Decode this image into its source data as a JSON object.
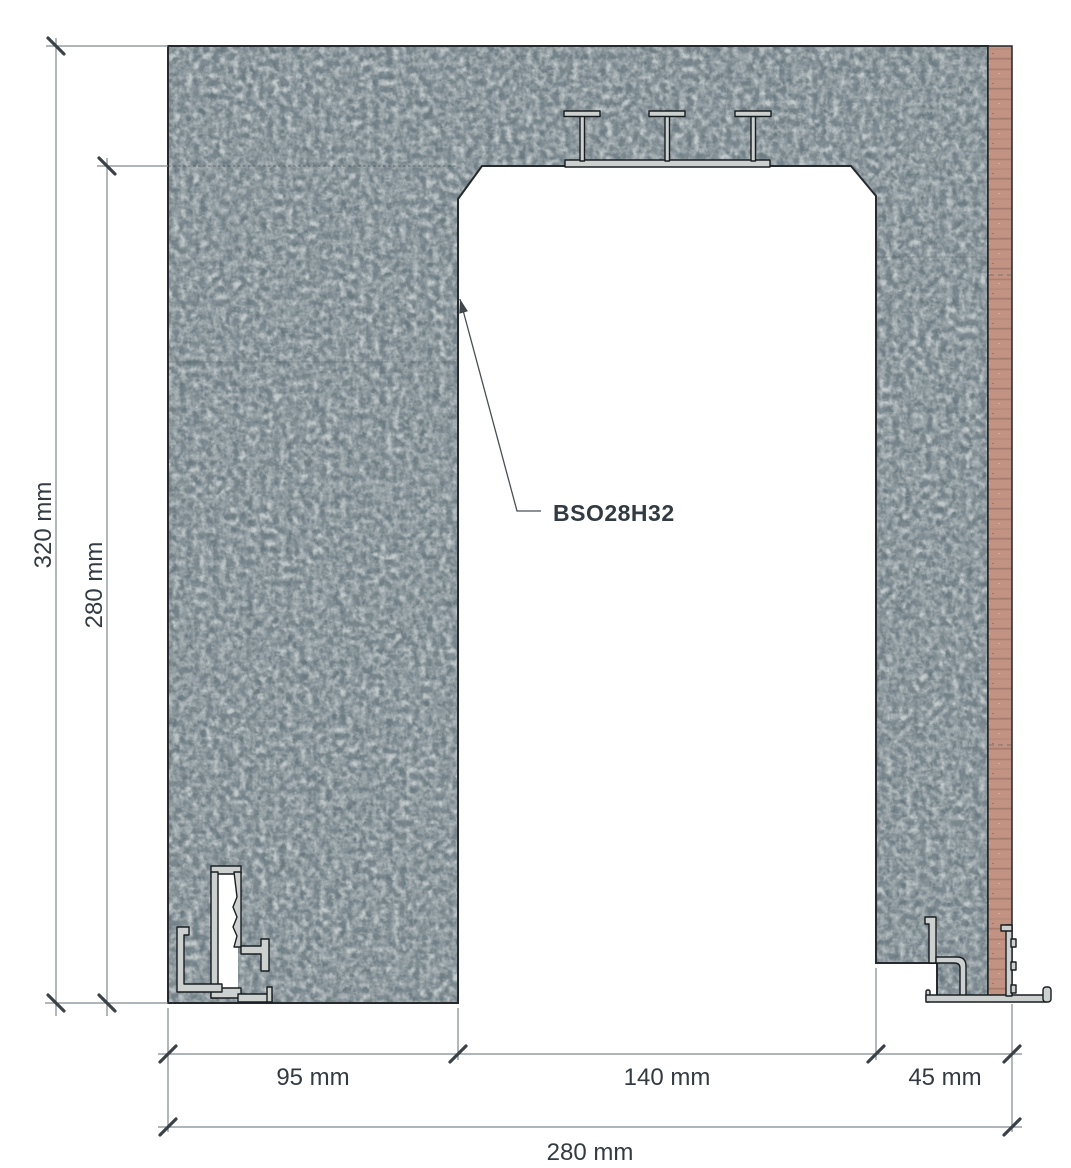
{
  "drawing": {
    "product_label": "BSO28H32",
    "dimensions": {
      "overall_height": "320 mm",
      "opening_height": "280 mm",
      "left_wall_width": "95 mm",
      "opening_width": "140 mm",
      "right_wall_width": "45 mm",
      "overall_width": "280 mm"
    },
    "legend": {
      "type": "technical cross-section of a pocket door frame (BSO28H32) in a masonry wall",
      "materials": [
        "masonry",
        "wood batten",
        "aluminium profiles"
      ]
    },
    "colors": {
      "background": "#ffffff",
      "masonry_base": "#6a7980",
      "masonry_dark_speckle": "#3f4b52",
      "masonry_light_speckle": "#939ea1",
      "wood": "#c29282",
      "wood_grain": "#aa8071",
      "aluminum": "#ccd1cf",
      "profile_outline": "#181d20",
      "dimension_line": "#7f898d",
      "tick": "#3a4247",
      "text": "#333b42"
    }
  }
}
